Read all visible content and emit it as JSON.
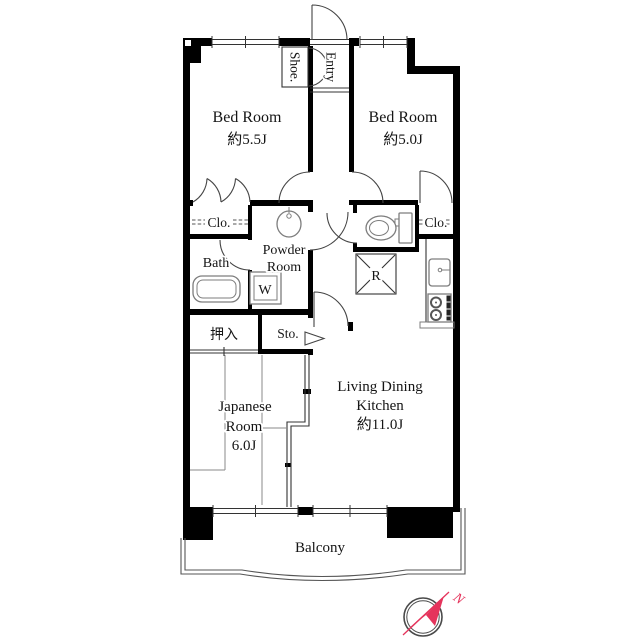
{
  "plan": {
    "rooms": {
      "bedroom_left": {
        "name": "Bed Room",
        "size": "約5.5J"
      },
      "bedroom_right": {
        "name": "Bed Room",
        "size": "約5.0J"
      },
      "entry": {
        "name": "Entry"
      },
      "shoe": {
        "name": "Shoe."
      },
      "closet_left": {
        "name": "Clo."
      },
      "closet_right": {
        "name": "Clo."
      },
      "powder_room": {
        "line1": "Powder",
        "line2": "Room"
      },
      "bath": {
        "name": "Bath"
      },
      "washer": {
        "name": "W"
      },
      "refrigerator": {
        "name": "R"
      },
      "oshiire": {
        "name": "押入"
      },
      "storage": {
        "name": "Sto."
      },
      "japanese_room": {
        "line1": "Japanese",
        "line2": "Room",
        "size": "6.0J"
      },
      "ldk": {
        "line1": "Living Dining",
        "line2": "Kitchen",
        "size": "約11.0J"
      },
      "balcony": {
        "name": "Balcony"
      }
    },
    "compass": {
      "label": "N",
      "color": "#e5345c",
      "ring_color": "#4a4a4a"
    },
    "colors": {
      "wall": "#000000"
    }
  }
}
